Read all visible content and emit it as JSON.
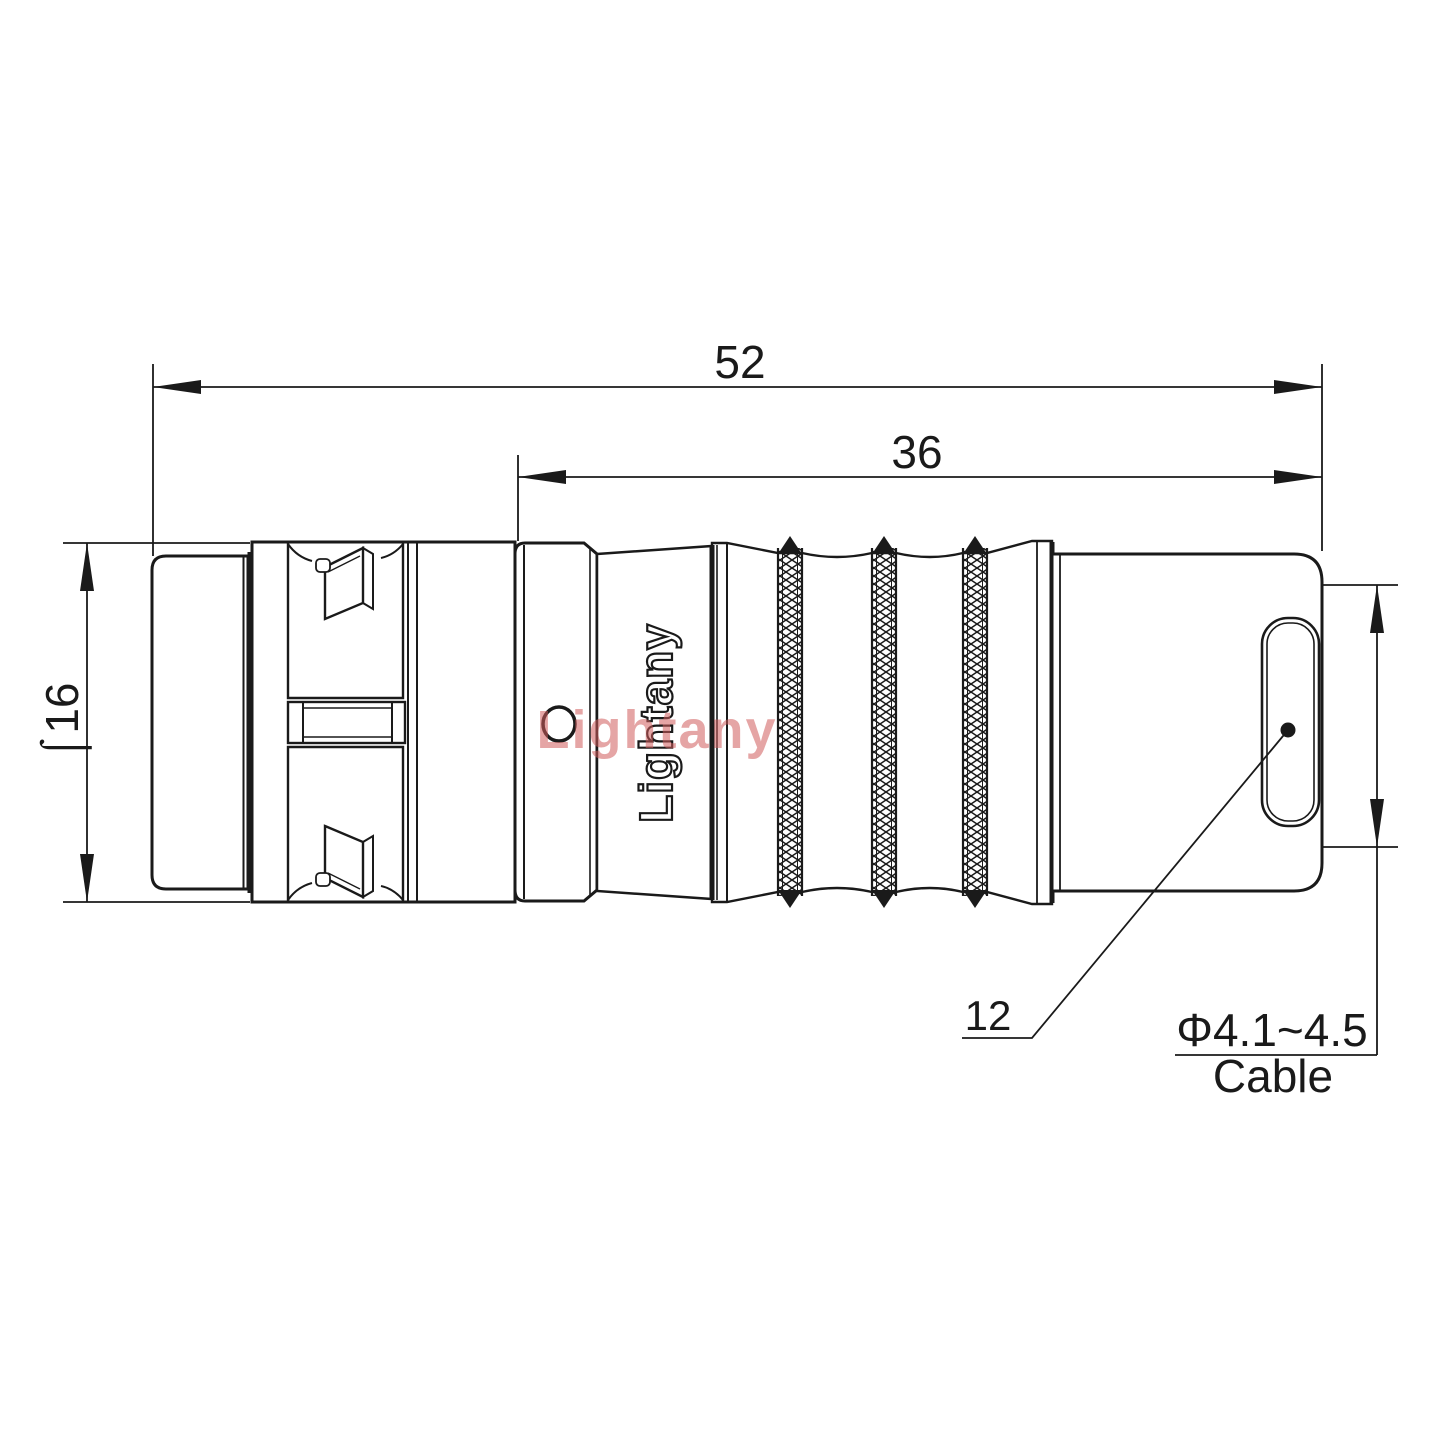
{
  "drawing": {
    "watermark_text": "Lightany",
    "brand_text": "Lightany",
    "dimensions": {
      "overall_length": "52",
      "rear_length": "36",
      "body_diameter": "⌠16",
      "rear_ref": "12",
      "cable_callout_value": "Φ4.1~4.5",
      "cable_callout_label": "Cable"
    },
    "colors": {
      "line": "#1a1a1a",
      "watermark": "#d05c5c",
      "background": "#ffffff"
    }
  }
}
